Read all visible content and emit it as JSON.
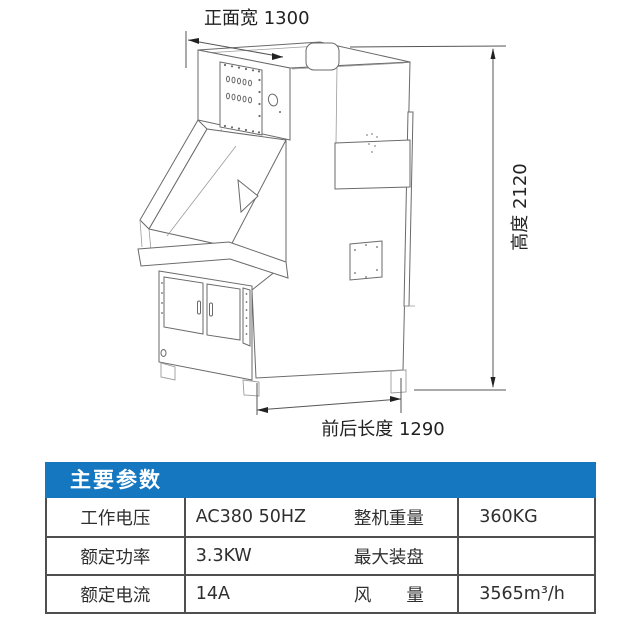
{
  "page": {
    "background": "#ffffff"
  },
  "diagram": {
    "line_color": "#6a6a6a",
    "dimensions": {
      "front_width": {
        "label": "正面宽 1300",
        "value": 1300
      },
      "height": {
        "label": "高度 2120",
        "value": 2120
      },
      "depth": {
        "label": "前后长度 1290",
        "value": 1290
      }
    }
  },
  "spec_table": {
    "title": "主要参数",
    "title_bg": "#1577c0",
    "title_color": "#ffffff",
    "border_color": "#4f4f4f",
    "rows": [
      [
        "工作电压",
        "AC380 50HZ",
        "整机重量",
        "360KG"
      ],
      [
        "额定功率",
        "3.3KW",
        "最大装盘",
        ""
      ],
      [
        "额定电流",
        "14A",
        "风　　量",
        "3565m³/h"
      ]
    ]
  }
}
